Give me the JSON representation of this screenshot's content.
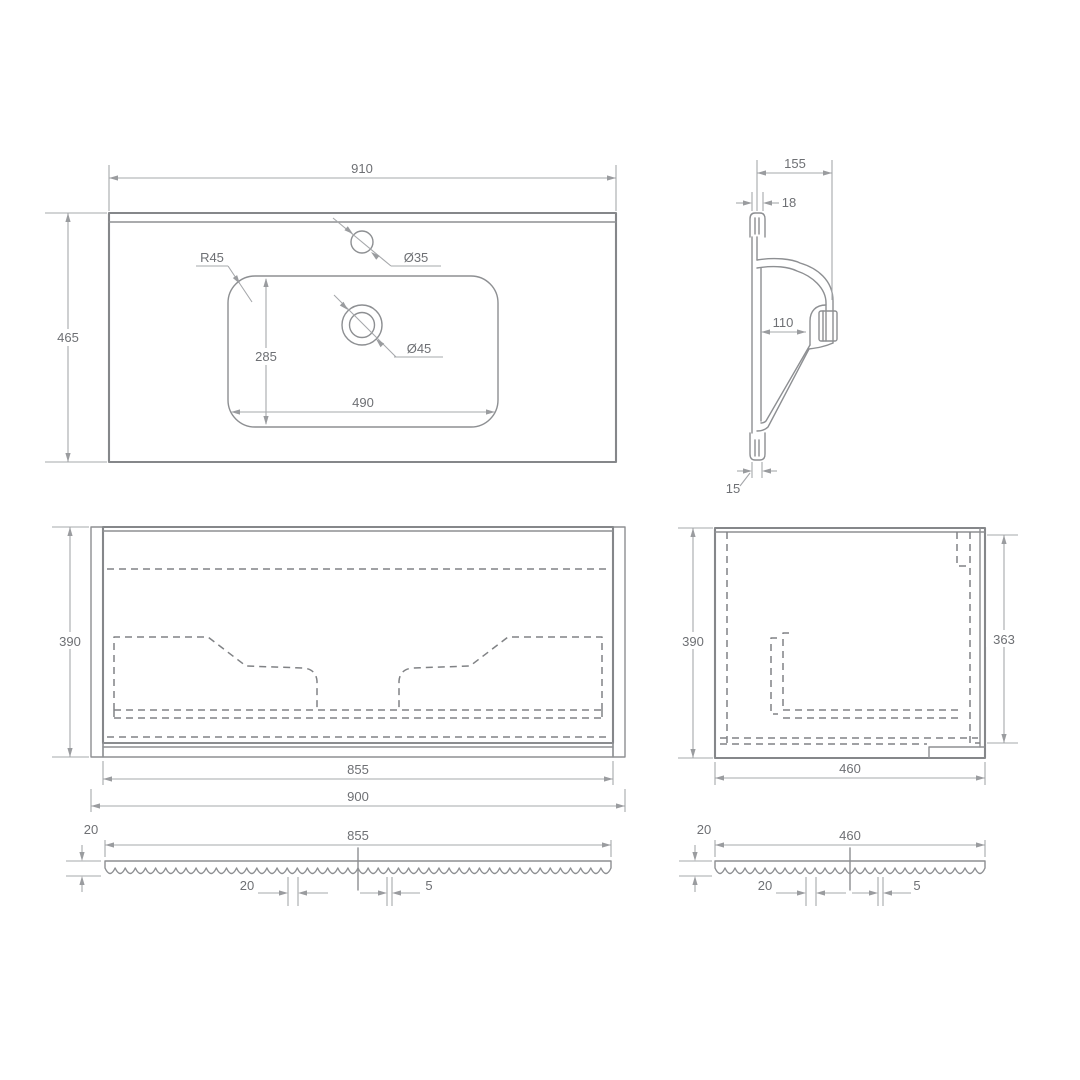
{
  "top_view": {
    "width": "910",
    "depth": "465",
    "corner_radius": "R45",
    "tap_hole_dia": "Ø35",
    "drain_hole_dia": "Ø45",
    "basin_depth": "285",
    "basin_width": "490"
  },
  "section_view": {
    "total_depth": "155",
    "wall_thickness": "18",
    "inner_depth": "110",
    "bottom_lip": "15"
  },
  "front_view": {
    "height": "390",
    "inner_width": "855",
    "total_width": "900"
  },
  "side_view": {
    "height": "390",
    "inner_height": "363",
    "depth": "460"
  },
  "front_strip": {
    "thickness": "20",
    "length": "855",
    "groove_pitch": "20",
    "groove_gap": "5"
  },
  "side_strip": {
    "thickness": "20",
    "length": "460",
    "groove_pitch": "20",
    "groove_gap": "5"
  }
}
